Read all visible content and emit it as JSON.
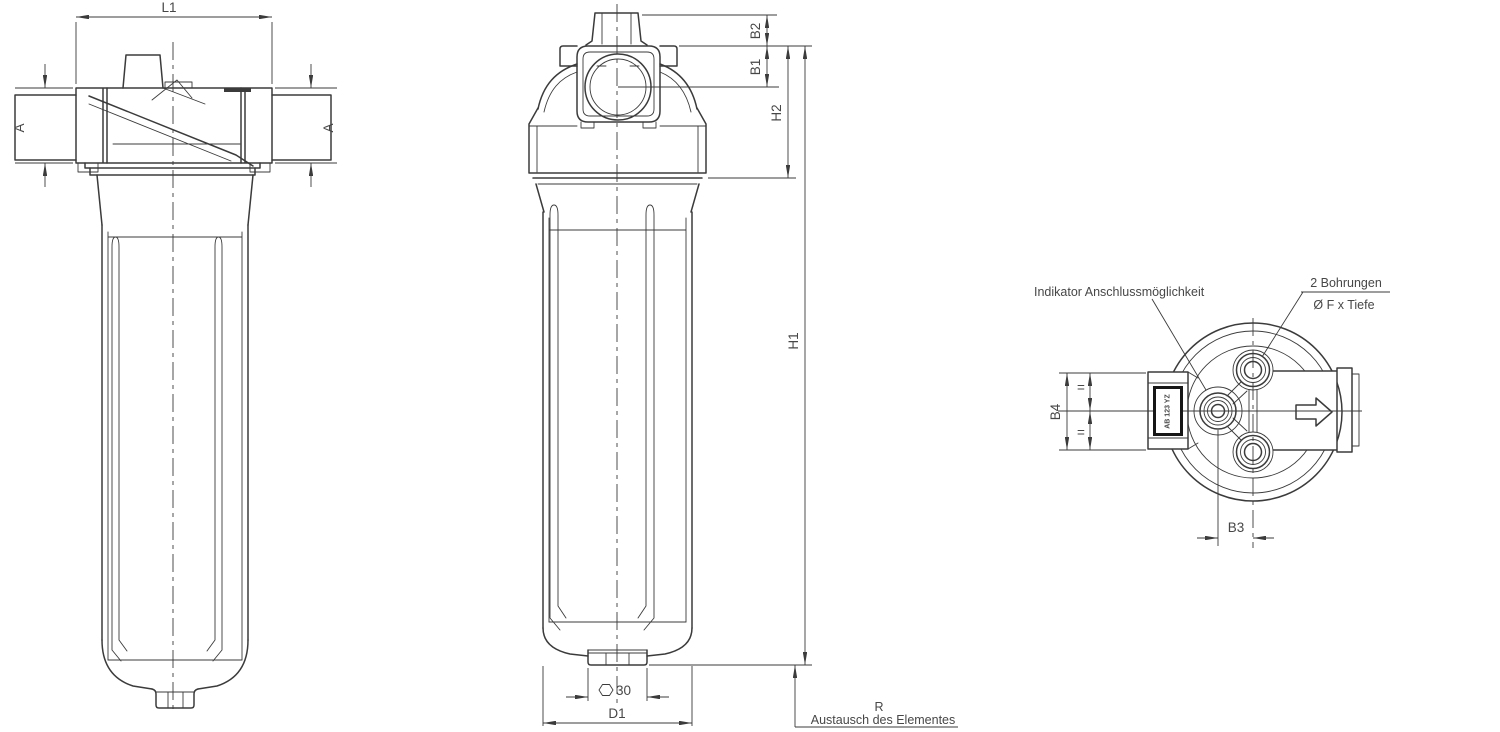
{
  "meta": {
    "background": "#ffffff",
    "line_color": "#3b3b3b",
    "text_color": "#474747"
  },
  "side_view": {
    "dim_l1": "L1",
    "dim_a_left": "A",
    "dim_a_right": "A"
  },
  "front_view": {
    "dim_b2": "B2",
    "dim_b1": "B1",
    "dim_h2": "H2",
    "dim_h1": "H1",
    "dim_hex": "30",
    "dim_d1": "D1",
    "note_r_symbol": "R",
    "note_r_text": "Austausch des Elementes"
  },
  "top_view": {
    "dim_b4": "B4",
    "dim_b3": "B3",
    "equal_mark_top": "=",
    "equal_mark_bottom": "=",
    "note_indicator": "Indikator Anschlussmöglichkeit",
    "note_holes_line1": "2 Bohrungen",
    "note_holes_line2": "Ø F x Tiefe",
    "indicator_port_label": "AB 123 YZ"
  }
}
